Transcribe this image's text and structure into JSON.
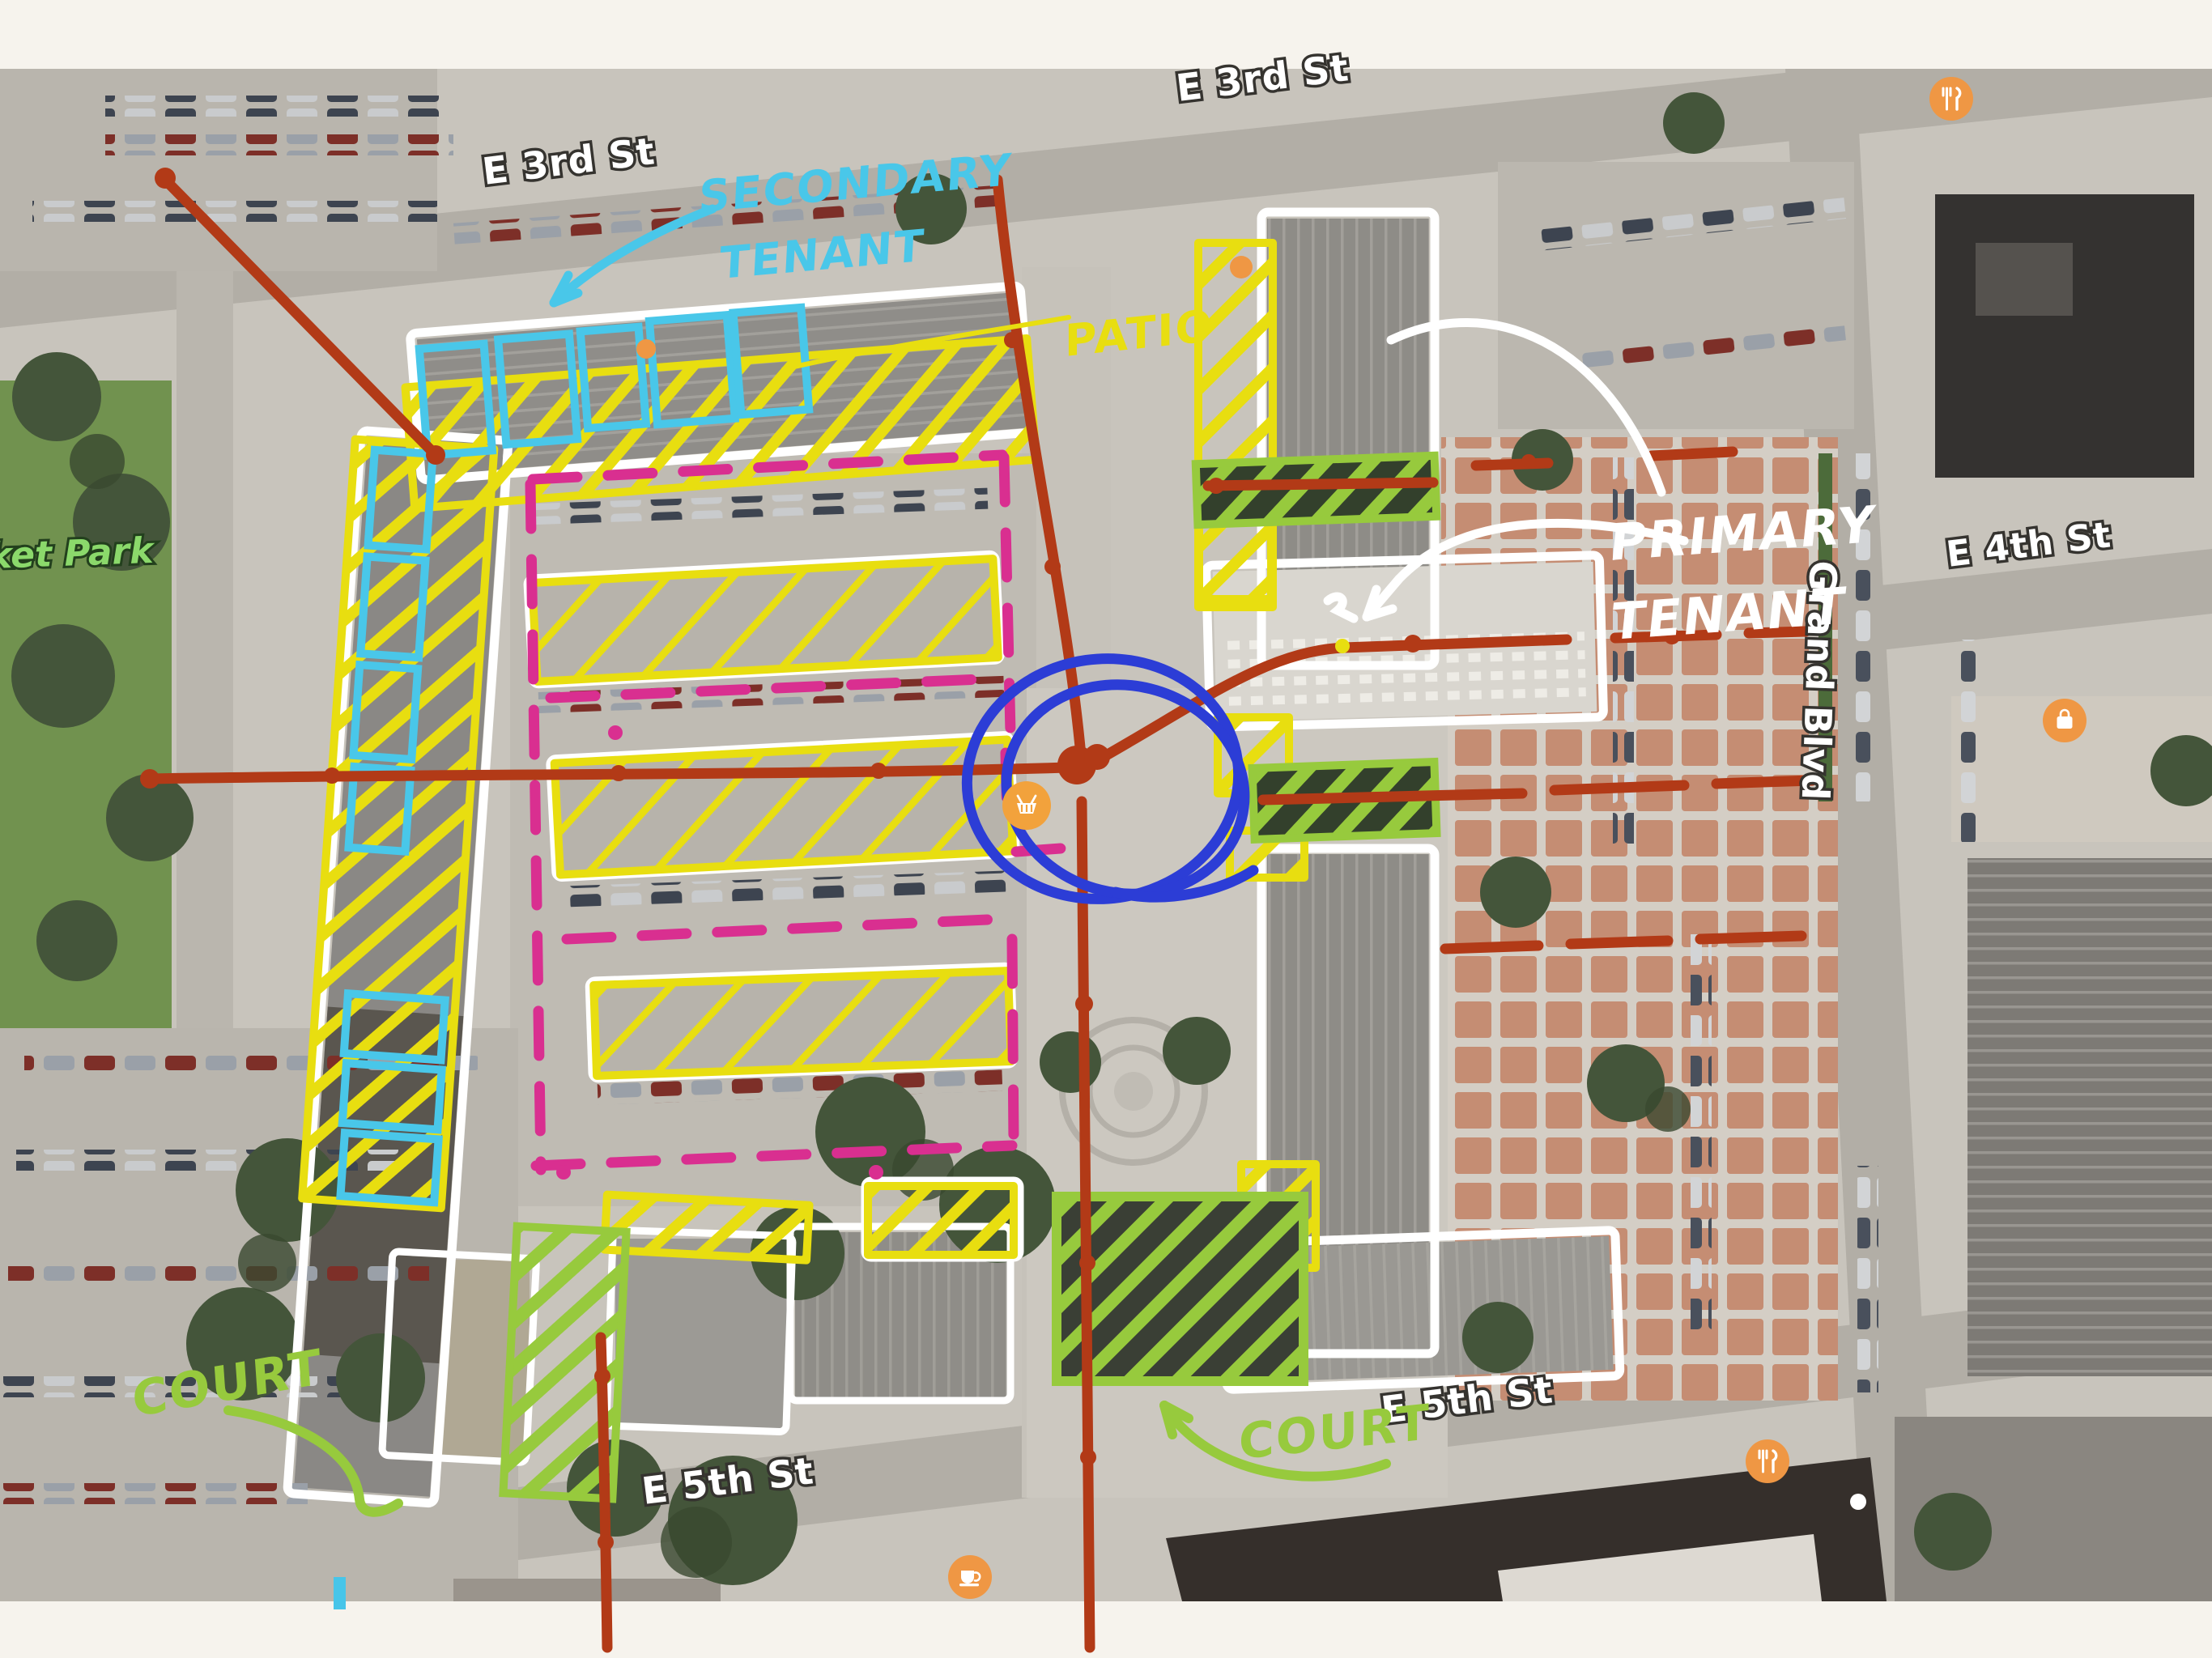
{
  "title": "Annotated satellite site plan (tenant / court / patio markup over aerial map)",
  "streets": {
    "e3rd_left": "E 3rd St",
    "e3rd_top": "E 3rd St",
    "e4th": "E 4th St",
    "e5th_left": "E 5th St",
    "e5th_mid": "E 5th St",
    "grand": "Grand Blvd",
    "park": "ket Park"
  },
  "annotations": {
    "secondary_line1": "SECONDARY",
    "secondary_line2": "TENANT",
    "patio": "PATIO",
    "primary_line1": "PRIMARY",
    "primary_line2": "TENANT",
    "court_left": "COURT",
    "court_mid": "COURT"
  },
  "colors": {
    "secondary_tenant_cyan": "#49C7E9",
    "patio_yellow": "#E8DE10",
    "primary_tenant_white": "#FFFFFF",
    "court_green": "#97CA3D",
    "parking_magenta": "#D92F90",
    "circulation_red": "#B23A17",
    "focus_circle_blue": "#2C3DD6",
    "street_label_fill": "#FFFFFF",
    "park_label_green": "#8BD96B",
    "poi_orange": "#EF9744"
  },
  "poi": [
    {
      "name": "restaurant-icon-top-right",
      "glyph": "fork-knife"
    },
    {
      "name": "restaurant-icon-bottom-right",
      "glyph": "fork-knife"
    },
    {
      "name": "coffee-icon-bottom",
      "glyph": "coffee-cup"
    },
    {
      "name": "shopping-bag-icon-right",
      "glyph": "bag"
    },
    {
      "name": "grocery-basket-icon-center",
      "glyph": "basket"
    }
  ]
}
